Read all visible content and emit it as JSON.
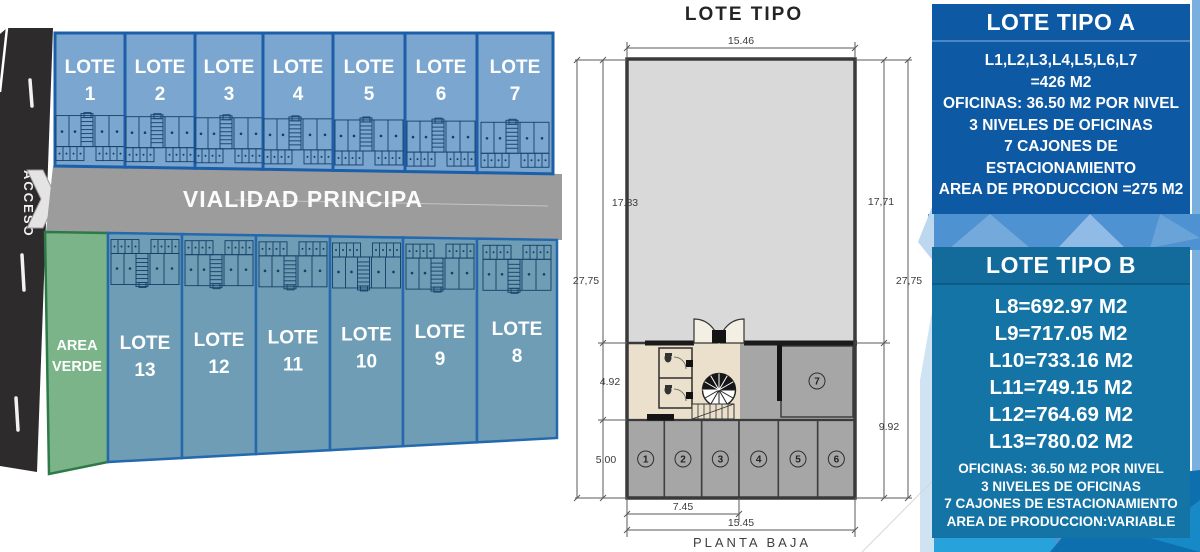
{
  "site": {
    "access_label": "ACCESO",
    "road_label": "VIALIDAD PRINCIPA",
    "green_area": {
      "line1": "AREA",
      "line2": "VERDE"
    },
    "lot_word": "LOTE",
    "top_lots": [
      "1",
      "2",
      "3",
      "4",
      "5",
      "6",
      "7"
    ],
    "bottom_lots": [
      "13",
      "12",
      "11",
      "10",
      "9",
      "8"
    ]
  },
  "plan": {
    "title": "LOTE TIPO",
    "caption": "PLANTA BAJA",
    "dims": {
      "top": "15.46",
      "left_upper": "17.83",
      "left_total": "27,75",
      "left_office": "4.92",
      "left_parking": "5.00",
      "right_upper": "17,71",
      "right_total": "27,75",
      "right_lower": "9.92",
      "bottom_inner": "7.45",
      "bottom_total": "15.45"
    },
    "parking_spots": [
      "1",
      "2",
      "3",
      "4",
      "5",
      "6"
    ],
    "parking_spot_upper": "7"
  },
  "panels": {
    "a": {
      "title": "LOTE TIPO A",
      "lines": [
        "L1,L2,L3,L4,L5,L6,L7",
        "=426 M2",
        "OFICINAS: 36.50 M2 POR NIVEL",
        "3 NIVELES DE OFICINAS",
        "7 CAJONES DE",
        "ESTACIONAMIENTO",
        "AREA DE PRODUCCION =275 M2"
      ]
    },
    "b": {
      "title": "LOTE TIPO B",
      "area_lines": [
        "L8=692.97 M2",
        "L9=717.05 M2",
        "L10=733.16 M2",
        "L11=749.15 M2",
        "L12=764.69 M2",
        "L13=780.02 M2"
      ],
      "detail_lines": [
        "OFICINAS: 36.50 M2 POR NIVEL",
        "3 NIVELES DE OFICINAS",
        "7 CAJONES DE ESTACIONAMIENTO",
        "AREA DE PRODUCCION:VARIABLE"
      ]
    }
  },
  "colors": {
    "road_dark": "#2e2b2c",
    "road_gray": "#9c9c9c",
    "lot_top_fill": "#7aa6d0",
    "lot_top_border": "#1c5fa8",
    "lot_bottom_fill": "#6e9db5",
    "lot_bottom_border": "#2468ad",
    "green_fill": "#7cb489",
    "green_border": "#2d7a48",
    "plan_gray": "#d9d9d9",
    "plan_beige": "#eae0cb",
    "plan_parking": "#a6a6a6",
    "panel_a_bg": "#0d59a3",
    "panel_b_bg": "#1474a6",
    "mini_line": "#173f66"
  }
}
